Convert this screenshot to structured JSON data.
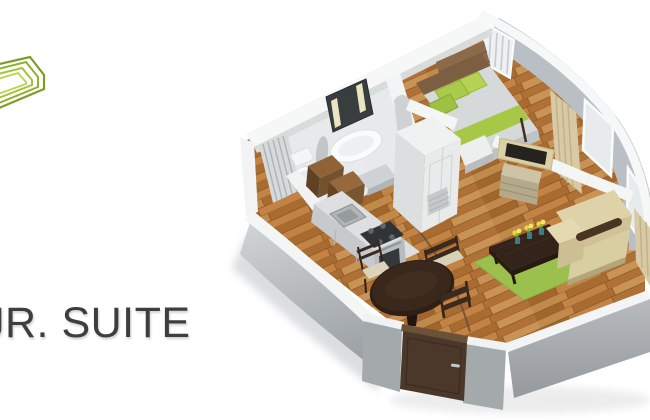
{
  "page": {
    "background": "#ffffff"
  },
  "logo": {
    "icon": "nested-frames-logo",
    "colors": [
      "#7d9c28",
      "#8fb02d",
      "#a2c338",
      "#b6d54a"
    ]
  },
  "title": {
    "text": "JR. SUITE",
    "color": "#3e3e3e"
  },
  "floorplan": {
    "type": "3d-floor-plan-render",
    "accent_green": "#a6c846",
    "pillow_green": "#a8cb49",
    "rug_green": "#9cc04d",
    "wall_white": "#f5f6f6",
    "wall_gray": "#a4a9ac",
    "floor_wood": "#b97a3c",
    "dark_wood": "#33231a",
    "door_brown": "#4b382b",
    "sofa_beige": "#d9cda2",
    "curtain_beige": "#d7caa5",
    "rooms": [
      {
        "name": "Bathroom",
        "items": [
          "lit mirror",
          "pedestal sink",
          "toilet",
          "radiator",
          "towel"
        ]
      },
      {
        "name": "Kitchen",
        "items": [
          "wood cabinets",
          "range hood",
          "cooktop",
          "oven",
          "steel sink",
          "counter"
        ]
      },
      {
        "name": "Bedroom",
        "items": [
          "double bed",
          "wood headboard",
          "green pillows",
          "green runner",
          "vertical blinds window",
          "foot bench",
          "wardrobe"
        ]
      },
      {
        "name": "Living room",
        "items": [
          "beige sofa",
          "green rug",
          "dark coffee table",
          "yellow flowers",
          "corner tv",
          "dresser",
          "curtains",
          "curved window wall"
        ]
      },
      {
        "name": "Dining area",
        "items": [
          "round dark table",
          "three chairs",
          "curved floor line"
        ]
      },
      {
        "name": "Entry",
        "items": [
          "brown entrance door",
          "metal handle"
        ]
      }
    ]
  }
}
